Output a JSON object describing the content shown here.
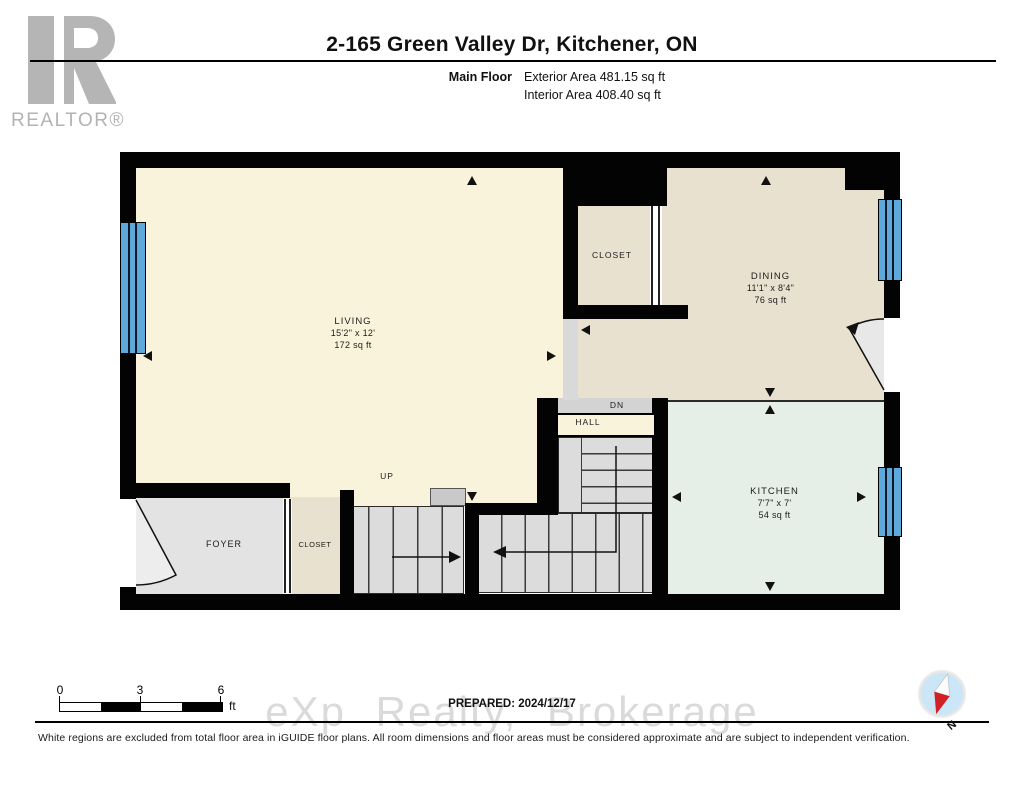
{
  "header": {
    "title": "2-165 Green Valley Dr, Kitchener, ON",
    "floor_label": "Main Floor",
    "exterior_area": "Exterior Area 481.15 sq ft",
    "interior_area": "Interior Area 408.40 sq ft"
  },
  "branding": {
    "realtor_text": "REALTOR®"
  },
  "rooms": {
    "living": {
      "name": "LIVING",
      "dims": "15'2\" x 12'",
      "area": "172 sq ft"
    },
    "closet_top": {
      "name": "CLOSET"
    },
    "dining": {
      "name": "DINING",
      "dims": "11'1\" x 8'4\"",
      "area": "76 sq ft"
    },
    "hall": {
      "name": "HALL"
    },
    "kitchen": {
      "name": "KITCHEN",
      "dims": "7'7\" x 7'",
      "area": "54 sq ft"
    },
    "foyer": {
      "name": "FOYER"
    },
    "closet_foyer": {
      "name": "CLOSET"
    }
  },
  "stairs": {
    "up": "UP",
    "down": "DN"
  },
  "scale_bar": {
    "ticks": [
      "0",
      "3",
      "6"
    ],
    "unit": "ft"
  },
  "compass": {
    "north_label": "N"
  },
  "footer": {
    "prepared": "PREPARED: 2024/12/17",
    "watermark": "eXp Realty, Brokerage",
    "disclaimer": "White regions are excluded from total floor area in iGUIDE floor plans. All room dimensions and floor areas must be considered approximate and are subject to independent verification."
  },
  "colors": {
    "wall": "#030303",
    "living_cream": "#faf3db",
    "closet_dining_beige": "#e9e1d0",
    "kitchen_green": "#e5efe7",
    "foyer_gray": "#e3e3e3",
    "stairs_gray": "#dcdcdc",
    "window_blue": "#5da9dc",
    "compass_red": "#d22027",
    "logo_gray": "#b5b5b5"
  }
}
